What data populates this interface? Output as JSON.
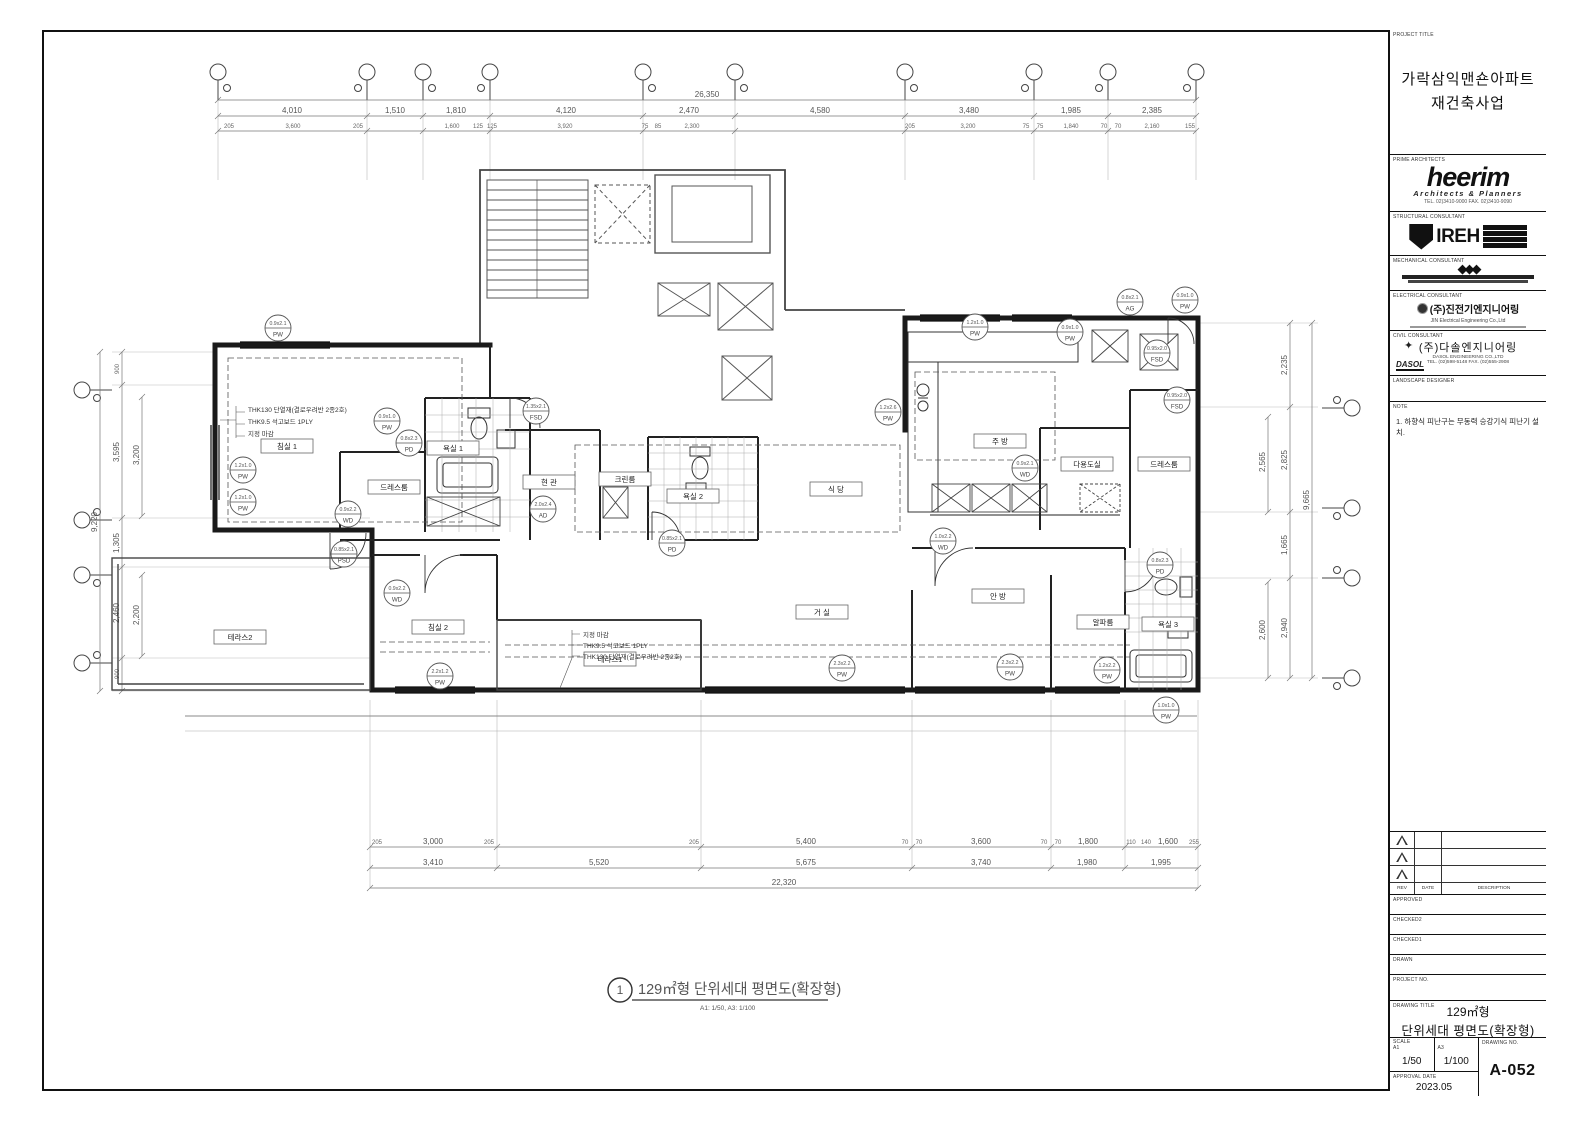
{
  "caption": {
    "number": "1",
    "title": "129㎡형 단위세대 평면도(확장형)",
    "scale": "A1: 1/50,  A3: 1/100"
  },
  "title_block": {
    "labels": {
      "project": "PROJECT TITLE",
      "prime": "PRIME ARCHITECTS",
      "structural": "STRUCTURAL CONSULTANT",
      "mechanical": "MECHANICAL CONSULTANT",
      "electrical": "ELECTRICAL CONSULTANT",
      "civil": "CIVIL CONSULTANT",
      "landscape": "LANDSCAPE DESIGNER",
      "note": "NOTE",
      "rev": "REV",
      "date": "DATE",
      "description": "DESCRIPTION",
      "approved": "APPROVED",
      "checked2": "CHECKED2",
      "checked1": "CHECKED1",
      "drawn": "DRAWN",
      "project_no": "PROJECT NO.",
      "drawing_title": "DRAWING TITLE",
      "scale": "SCALE",
      "a1": "A1",
      "a3": "A3",
      "approval_date": "APPROVAL DATE",
      "drawing_no": "DRAWING NO."
    },
    "project_title": {
      "line1": "가락삼익맨숀아파트",
      "line2": "재건축사업"
    },
    "prime": {
      "name": "heerim",
      "sub": "Architects & Planners",
      "contact": "TEL. 02)3410-9000  FAX. 02)3410-9090"
    },
    "structural": {
      "name": "IREH"
    },
    "electrical": {
      "name": "(주)진전기엔지니어링",
      "sub": "JIN Electrical Engineering Co.,Ltd"
    },
    "civil": {
      "name": "(주)다솔엔지니어링",
      "sub": "DASOL ENGINEERING CO.,LTD",
      "contact": "TEL. (02)598-5148  FAX. (02)555-2908",
      "logo": "DASOL"
    },
    "note": "1. 하향식 피난구는 무동력 승강기식 피난기 설치.",
    "drawing_title": {
      "line1": "129㎡형",
      "line2": "단위세대 평면도(확장형)"
    },
    "scale_a1": "1/50",
    "scale_a3": "1/100",
    "approval_date": "2023.05",
    "drawing_no": "A-052"
  },
  "plan": {
    "rooms": {
      "bed1": "침실 1",
      "bath1": "욕실 1",
      "dress1": "드레스룸",
      "entry": "현 관",
      "clean": "크린룸",
      "bath2": "욕실 2",
      "dining": "식 당",
      "kitchen": "주 방",
      "utility": "다용도실",
      "dress2": "드레스룸",
      "living": "거 실",
      "master": "안 방",
      "alpha": "알파룸",
      "bath3": "욕실 3",
      "bed2": "침실 2",
      "terrace1": "테라스1",
      "terrace2": "테라스2"
    },
    "notes_wall": {
      "n1": "THK130 단열재(결로우려반 2종2호)",
      "n2": "THK9.5 석고보드 1PLY",
      "n3": "지정 마감"
    },
    "dims": {
      "top": {
        "overall": "26,350",
        "segs": [
          "4,010",
          "1,510",
          "1,810",
          "4,120",
          "2,470",
          "4,580",
          "3,480",
          "1,985",
          "2,385"
        ],
        "inner": [
          "205",
          "3,600",
          "205",
          "1,600",
          "125",
          "125",
          "3,920",
          "75",
          "85",
          "2,300",
          "205",
          "3,200",
          "75",
          "75",
          "1,840",
          "70",
          "70",
          "2,160",
          "155"
        ]
      },
      "bottom": {
        "overall": "22,320",
        "rowA": [
          "205",
          "3,000",
          "205",
          "205",
          "5,400",
          "70",
          "70",
          "3,600",
          "70",
          "70",
          "1,800",
          "110",
          "140",
          "1,600",
          "255"
        ],
        "rowB": [
          "3,410",
          "5,520",
          "5,675",
          "3,740",
          "1,980",
          "1,995"
        ]
      },
      "left": {
        "overall": "9,220",
        "chain": [
          "900",
          "3,595",
          "1,305",
          "2,460",
          "900"
        ],
        "inner": [
          "3,200",
          "2,200"
        ]
      },
      "right": {
        "overall": "9,665",
        "chain": [
          "2,235",
          "2,825",
          "1,665",
          "2,940"
        ],
        "inner": [
          "2,565",
          "2,600"
        ]
      }
    },
    "tags": [
      {
        "s": "0.9x2.1",
        "c": "PW"
      },
      {
        "s": "0.9x1.0",
        "c": "PW"
      },
      {
        "s": "0.8x2.3",
        "c": "PD"
      },
      {
        "s": "1.2x1.0",
        "c": "PW"
      },
      {
        "s": "1.2x1.0",
        "c": "PW"
      },
      {
        "s": "0.9x2.2",
        "c": "WD"
      },
      {
        "s": "0.85x2.1",
        "c": "PSD"
      },
      {
        "s": "1.35x2.1",
        "c": "FSD"
      },
      {
        "s": "2.0x2.4",
        "c": "AD"
      },
      {
        "s": "0.85x2.1",
        "c": "PD"
      },
      {
        "s": "1.2x2.6",
        "c": "PW"
      },
      {
        "s": "1.2x1.0",
        "c": "PW"
      },
      {
        "s": "0.9x1.0",
        "c": "PW"
      },
      {
        "s": "0.8x2.1",
        "c": "AG"
      },
      {
        "s": "0.9x1.0",
        "c": "PW"
      },
      {
        "s": "0.95x2.0",
        "c": "FSD"
      },
      {
        "s": "0.95x2.0",
        "c": "FSD"
      },
      {
        "s": "0.9x2.1",
        "c": "WD"
      },
      {
        "s": "1.0x2.2",
        "c": "WD"
      },
      {
        "s": "0.9x2.2",
        "c": "WD"
      },
      {
        "s": "2.3x2.2",
        "c": "PW"
      },
      {
        "s": "2.3x2.2",
        "c": "PW"
      },
      {
        "s": "1.2x2.2",
        "c": "PW"
      },
      {
        "s": "0.8x2.3",
        "c": "PD"
      },
      {
        "s": "2.2x1.2",
        "c": "PW"
      },
      {
        "s": "1.0x1.0",
        "c": "PW"
      }
    ]
  }
}
